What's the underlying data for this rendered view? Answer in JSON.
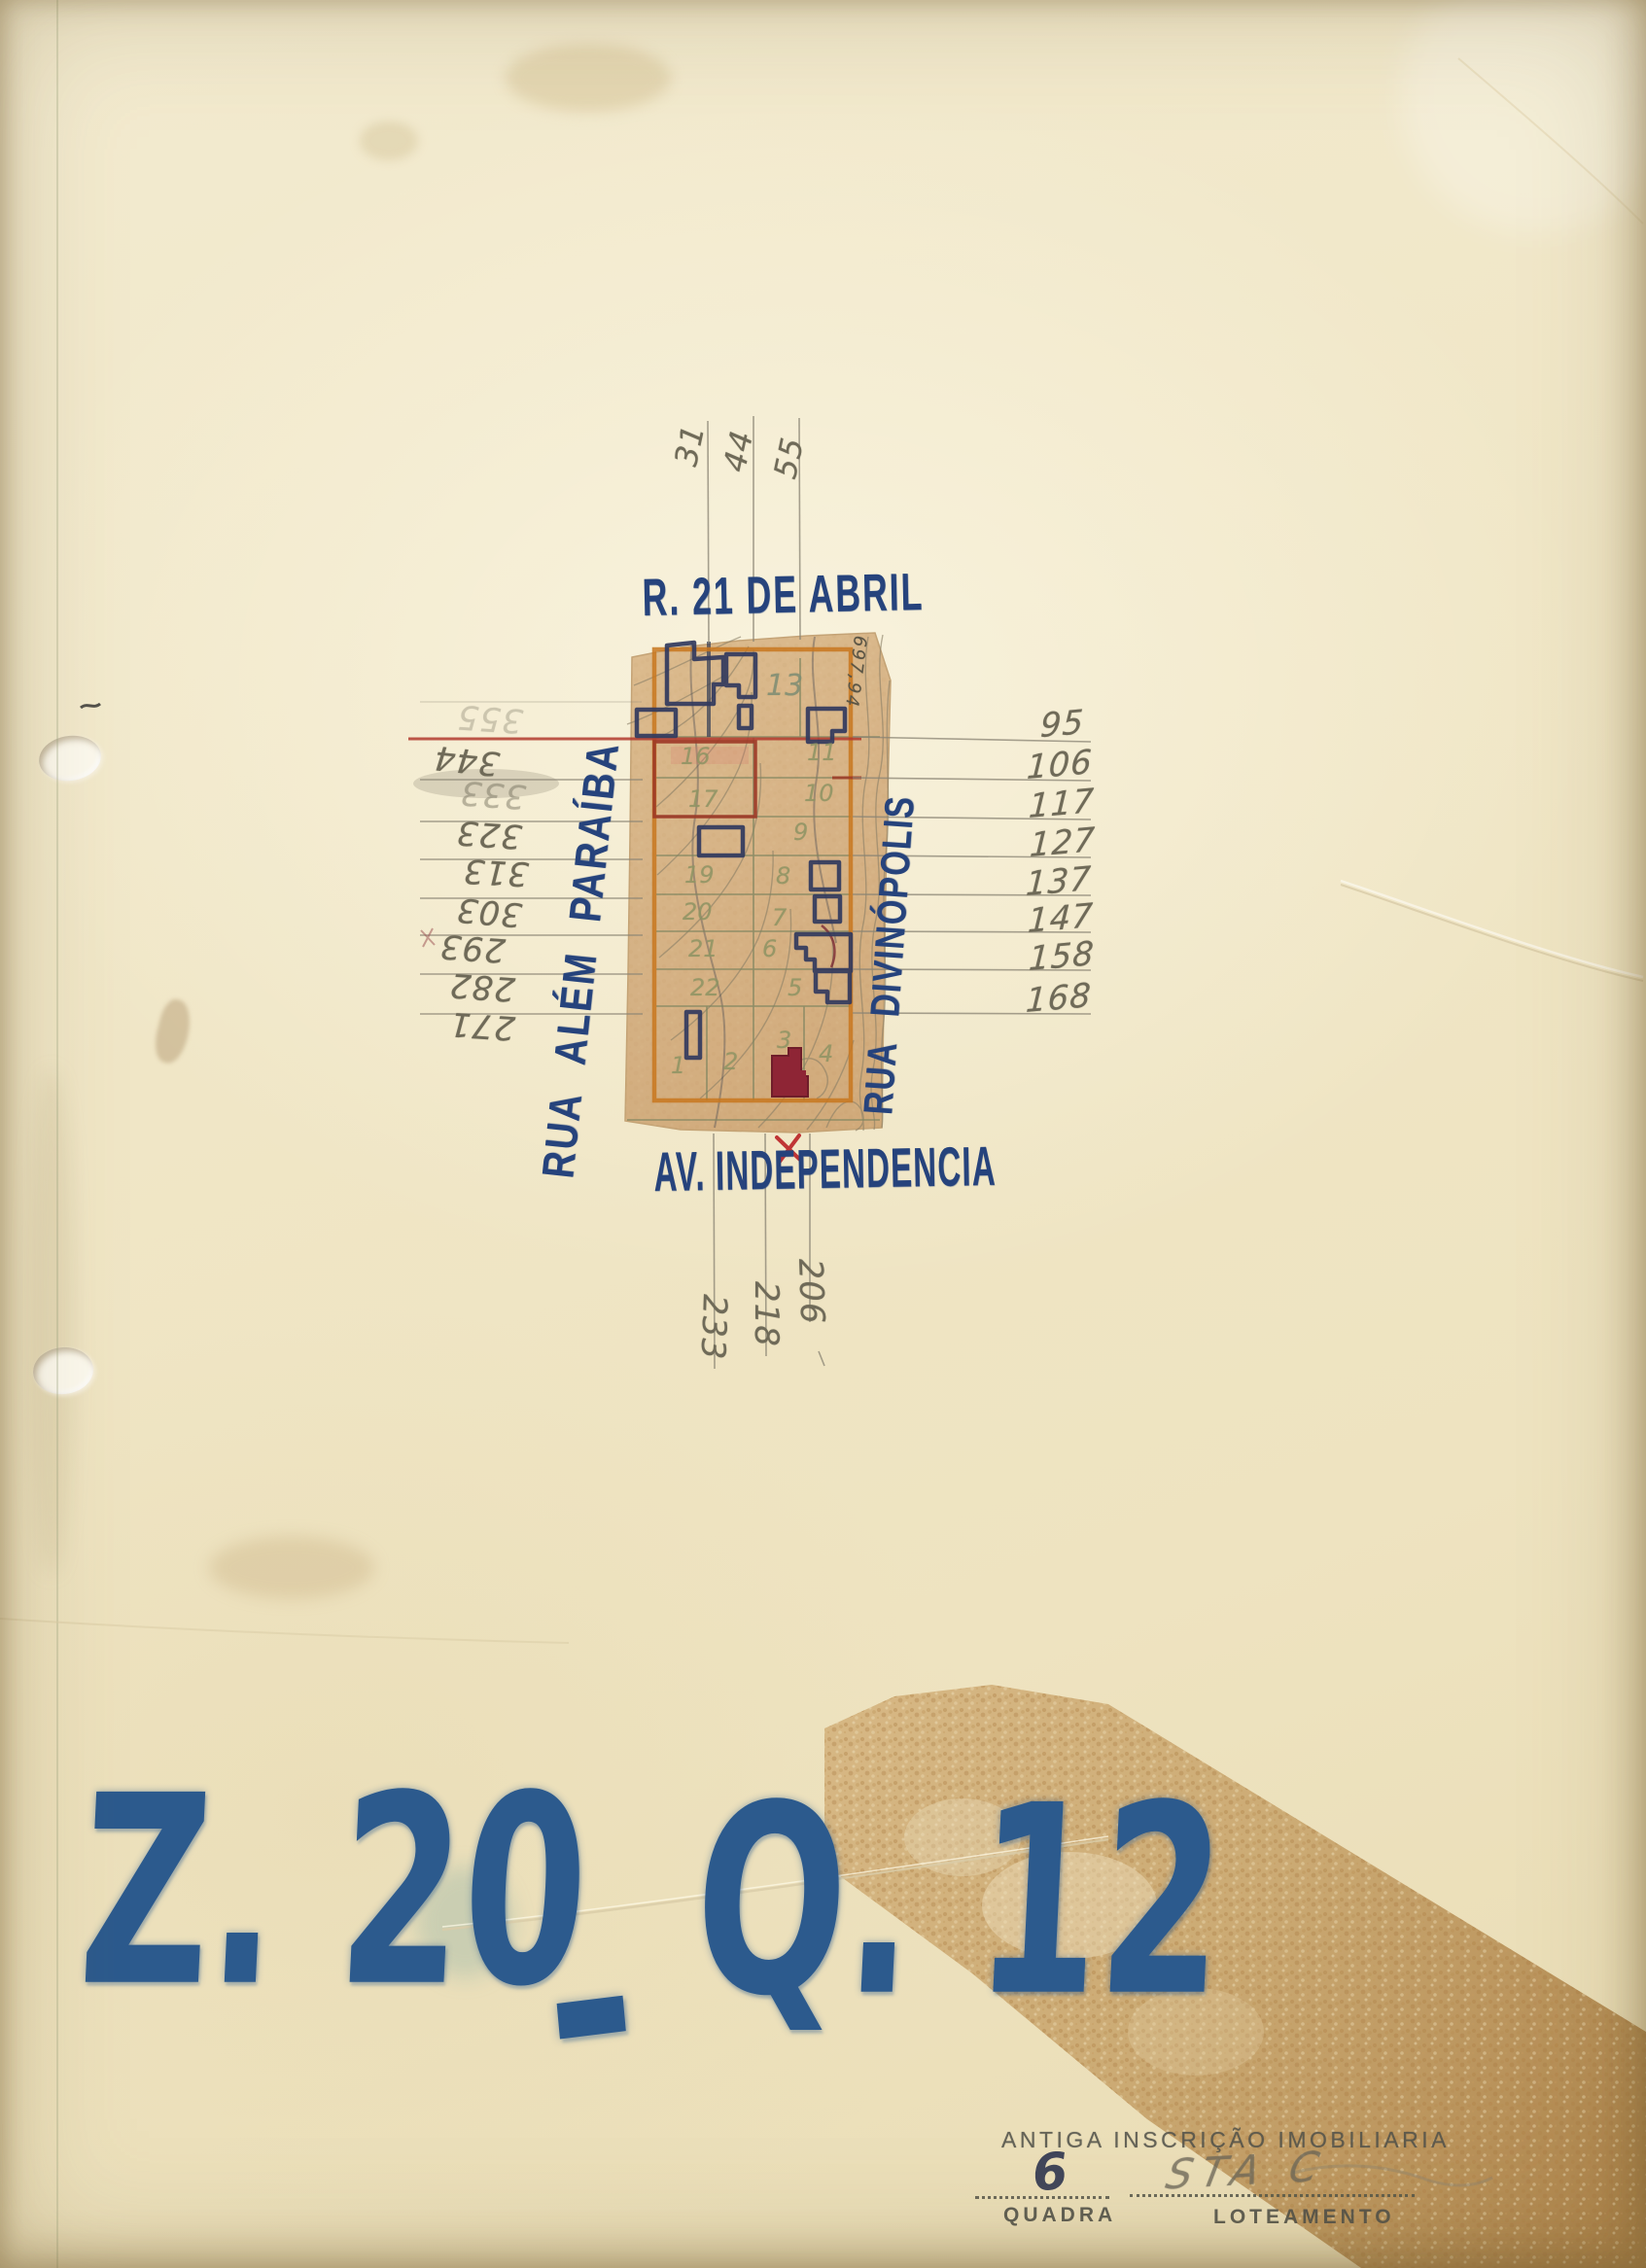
{
  "code": {
    "zone": "Z. 20",
    "separator": "-",
    "quadra": "Q. 12"
  },
  "streets": {
    "top": "R. 21 DE ABRIL",
    "left": "RUA ALÉM PARAÍBA",
    "right": "RUA DIVINÓPOLIS",
    "bottom": "AV. INDEPENDENCIA"
  },
  "survey": {
    "top_marks": [
      {
        "value": "31"
      },
      {
        "value": "44"
      },
      {
        "value": "55"
      }
    ],
    "left_marks": [
      {
        "value": "355"
      },
      {
        "value": "344"
      },
      {
        "value": "333"
      },
      {
        "value": "323"
      },
      {
        "value": "313"
      },
      {
        "value": "303"
      },
      {
        "value": "293"
      },
      {
        "value": "282"
      },
      {
        "value": "271"
      }
    ],
    "right_marks": [
      {
        "value": "95"
      },
      {
        "value": "106"
      },
      {
        "value": "117"
      },
      {
        "value": "127"
      },
      {
        "value": "137"
      },
      {
        "value": "147"
      },
      {
        "value": "158"
      },
      {
        "value": "168"
      }
    ],
    "bottom_marks": [
      {
        "value": "233"
      },
      {
        "value": "218"
      },
      {
        "value": "206"
      }
    ]
  },
  "map": {
    "elevation_label": "697,94",
    "lots": [
      {
        "n": "13"
      },
      {
        "n": "11"
      },
      {
        "n": "10"
      },
      {
        "n": "9"
      },
      {
        "n": "8"
      },
      {
        "n": "7"
      },
      {
        "n": "6"
      },
      {
        "n": "5"
      },
      {
        "n": "16"
      },
      {
        "n": "17"
      },
      {
        "n": "19"
      },
      {
        "n": "20"
      },
      {
        "n": "21"
      },
      {
        "n": "22"
      },
      {
        "n": "1"
      },
      {
        "n": "2"
      },
      {
        "n": "3"
      },
      {
        "n": "4"
      }
    ]
  },
  "form": {
    "stamp": "ANTIGA  INSCRIÇÃO  IMOBILIARIA",
    "quadra_value": "6",
    "quadra_label": "QUADRA",
    "loteamento_value": "STA C",
    "loteamento_label": "LOTEAMENTO"
  },
  "colors": {
    "paper_cream": "#f1e8cb",
    "map_paper_tan": "#d7b285",
    "ink_blue": "#26437c",
    "marker_blue": "#2c5a8d",
    "pencil_gray": "#6f6a58",
    "olive_pencil": "#8f9464",
    "map_border_orange": "#c8771f",
    "lot_outline_red": "#9c3726",
    "building_navy": "#323a5e",
    "building_red_fill": "#8e2535",
    "red_cross": "#c03535",
    "tape_tan": "#c9a36a"
  }
}
